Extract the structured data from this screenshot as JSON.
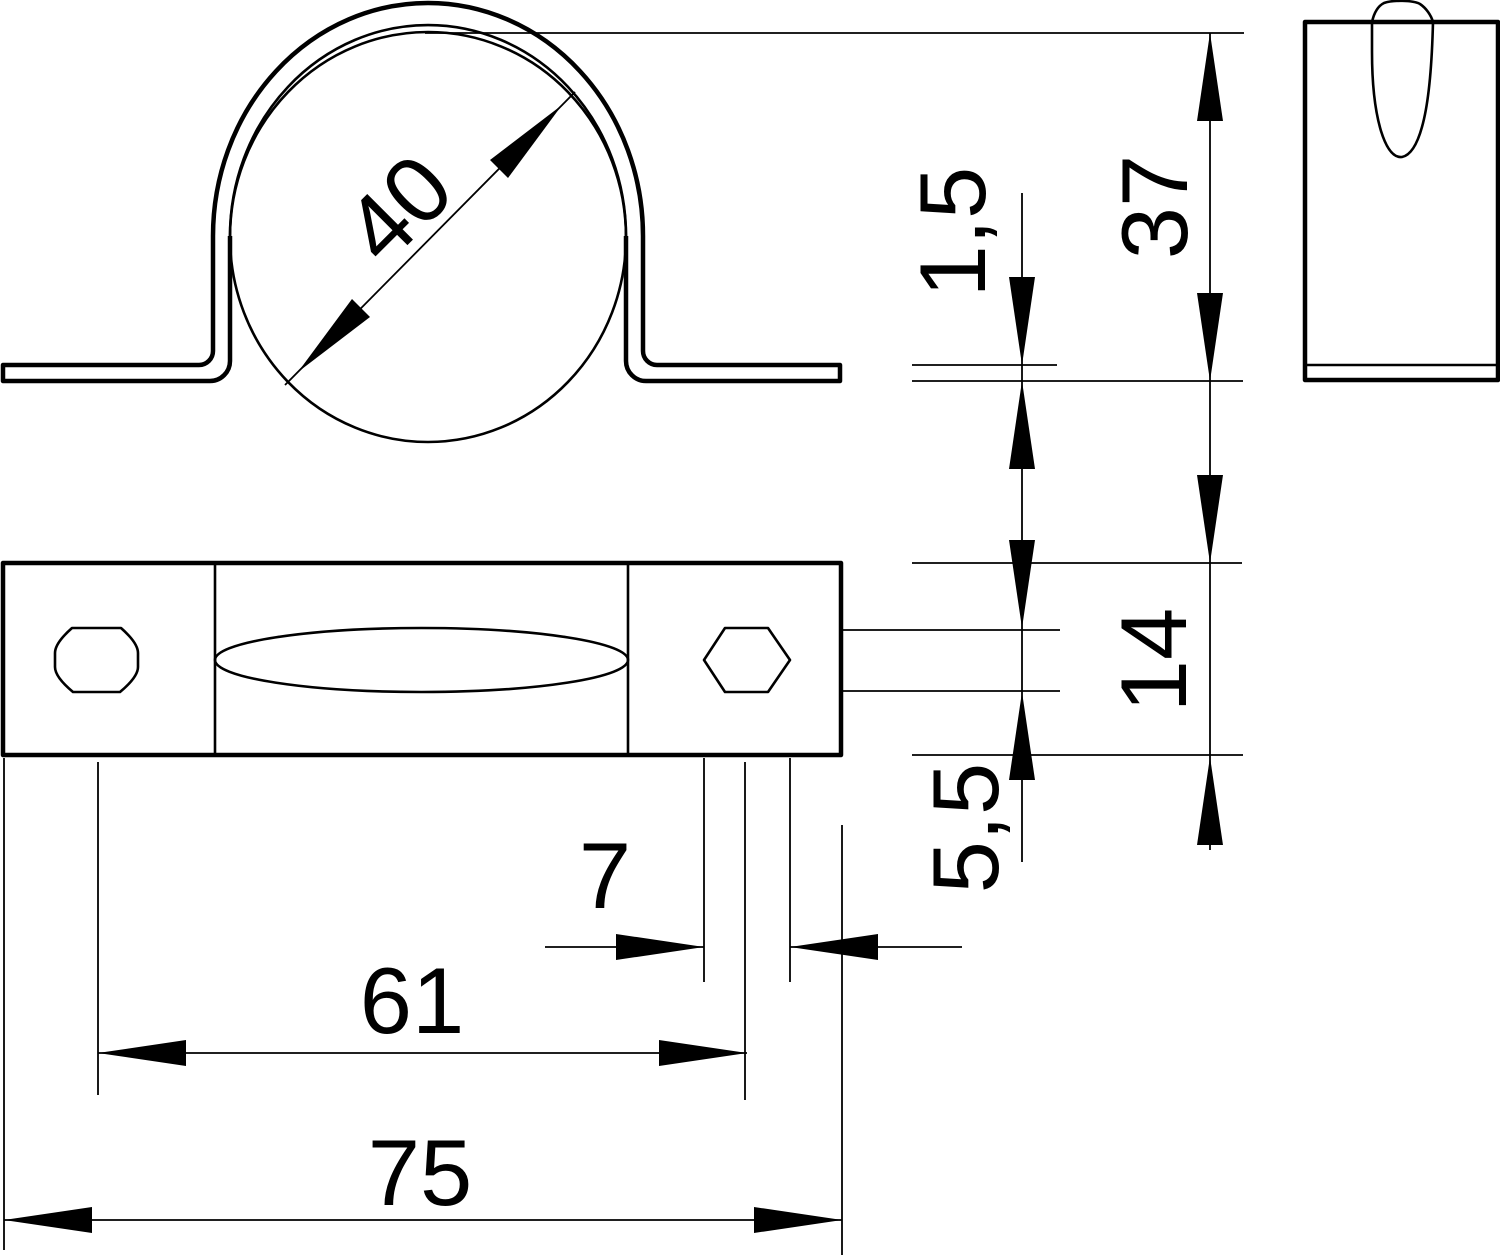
{
  "drawing": {
    "background": "#ffffff",
    "line_color": "#000000",
    "views": {
      "front": "front view of pipe saddle clamp",
      "top": "top view of base plate with holes and slot",
      "side": "side view with tongue cutout"
    },
    "dimensions": {
      "pipe_diameter": "40",
      "clamp_height": "37",
      "material_thickness": "1,5",
      "strap_width": "14",
      "hole_width": "5,5",
      "hole_length": "7",
      "hole_spacing": "61",
      "overall_length": "75"
    }
  }
}
